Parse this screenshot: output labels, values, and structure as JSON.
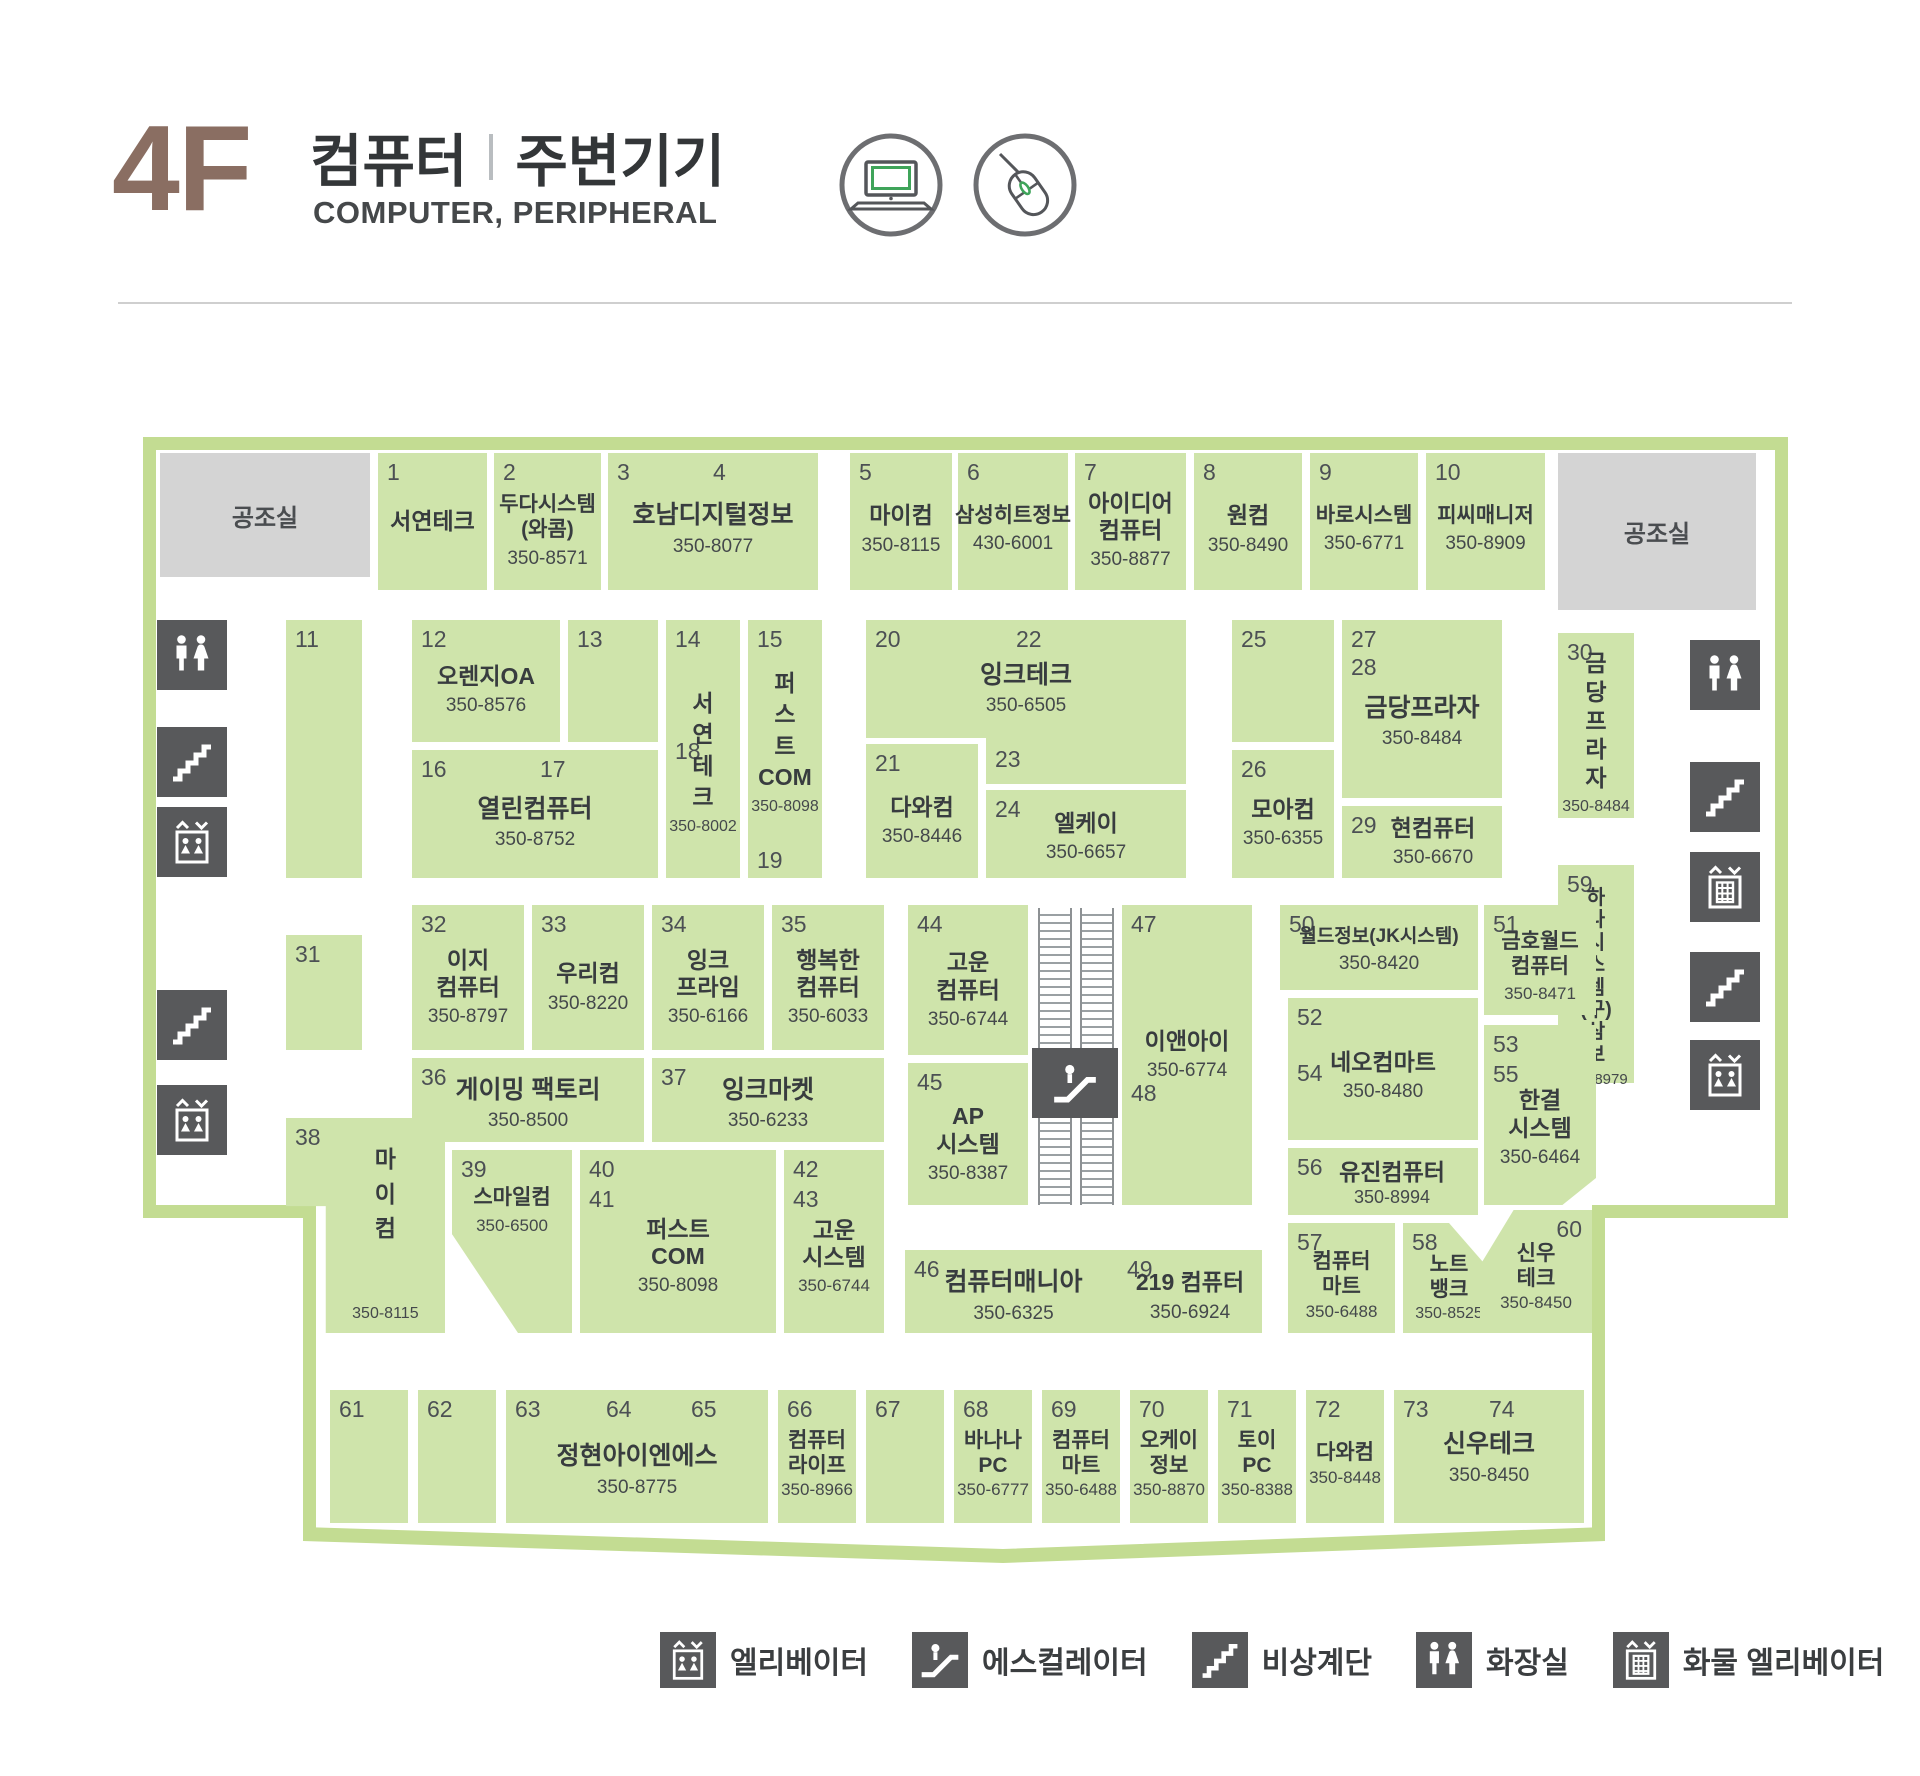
{
  "header": {
    "floor": "4F",
    "title_left": "컴퓨터",
    "title_right": "주변기기",
    "subtitle": "COMPUTER, PERIPHERAL"
  },
  "colors": {
    "block_green": "#cfe4ab",
    "outline_green": "#c3dc92",
    "machine_room_gray": "#d4d4d4",
    "icon_gray": "#58595b",
    "floor_label_brown": "#8a6e62",
    "accent_green": "#3fa45a"
  },
  "legend": {
    "items": [
      {
        "icon": "elevator-icon",
        "label": "엘리베이터"
      },
      {
        "icon": "escalator-icon",
        "label": "에스컬레이터"
      },
      {
        "icon": "stairs-icon",
        "label": "비상계단"
      },
      {
        "icon": "restroom-icon",
        "label": "화장실"
      },
      {
        "icon": "freight-elevator-icon",
        "label": "화물 엘리베이터"
      }
    ]
  },
  "map": {
    "machine_room_label": "공조실",
    "blocks": {
      "b1": {
        "nums": [
          "1"
        ],
        "name": "서연테크",
        "phone": ""
      },
      "b2": {
        "nums": [
          "2"
        ],
        "name": "두다시스템\n(와콤)",
        "phone": "350-8571"
      },
      "b3_4": {
        "nums": [
          "3",
          "4"
        ],
        "name": "호남디지털정보",
        "phone": "350-8077"
      },
      "b5": {
        "nums": [
          "5"
        ],
        "name": "마이컴",
        "phone": "350-8115"
      },
      "b6": {
        "nums": [
          "6"
        ],
        "name": "삼성히트정보",
        "phone": "430-6001"
      },
      "b7": {
        "nums": [
          "7"
        ],
        "name": "아이디어\n컴퓨터",
        "phone": "350-8877"
      },
      "b8": {
        "nums": [
          "8"
        ],
        "name": "원컴",
        "phone": "350-8490"
      },
      "b9": {
        "nums": [
          "9"
        ],
        "name": "바로시스템",
        "phone": "350-6771"
      },
      "b10": {
        "nums": [
          "10"
        ],
        "name": "피씨매니저",
        "phone": "350-8909"
      },
      "b11": {
        "nums": [
          "11"
        ],
        "name": "",
        "phone": ""
      },
      "b12": {
        "nums": [
          "12"
        ],
        "name": "오렌지OA",
        "phone": "350-8576"
      },
      "b13": {
        "nums": [
          "13"
        ],
        "name": "",
        "phone": ""
      },
      "b14_18": {
        "nums": [
          "14",
          "18"
        ],
        "name": "서\n연\n테\n크",
        "phone": "350-8002"
      },
      "b15_19": {
        "nums": [
          "15",
          "19"
        ],
        "name": "퍼\n스\n트\nCOM",
        "phone": "350-8098"
      },
      "b16_17": {
        "nums": [
          "16",
          "17"
        ],
        "name": "열린컴퓨터",
        "phone": "350-8752"
      },
      "b20_22": {
        "nums": [
          "20",
          "22",
          "23"
        ],
        "name": "잉크테크",
        "phone": "350-6505"
      },
      "b21": {
        "nums": [
          "21"
        ],
        "name": "다와컴",
        "phone": "350-8446"
      },
      "b24": {
        "nums": [
          "24"
        ],
        "name": "엘케이",
        "phone": "350-6657"
      },
      "b25": {
        "nums": [
          "25"
        ],
        "name": "",
        "phone": ""
      },
      "b26": {
        "nums": [
          "26"
        ],
        "name": "모아컴",
        "phone": "350-6355"
      },
      "b27_28": {
        "nums": [
          "27",
          "28"
        ],
        "name": "금당프라자",
        "phone": "350-8484"
      },
      "b29": {
        "nums": [
          "29"
        ],
        "name": "현컴퓨터",
        "phone": "350-6670"
      },
      "b30": {
        "nums": [
          "30"
        ],
        "name": "금\n당\n프\n라\n자",
        "phone": "350-8484"
      },
      "b31": {
        "nums": [
          "31"
        ],
        "name": "",
        "phone": ""
      },
      "b32": {
        "nums": [
          "32"
        ],
        "name": "이지\n컴퓨터",
        "phone": "350-8797"
      },
      "b33": {
        "nums": [
          "33"
        ],
        "name": "우리컴",
        "phone": "350-8220"
      },
      "b34": {
        "nums": [
          "34"
        ],
        "name": "잉크\n프라임",
        "phone": "350-6166"
      },
      "b35": {
        "nums": [
          "35"
        ],
        "name": "행복한\n컴퓨터",
        "phone": "350-6033"
      },
      "b36": {
        "nums": [
          "36"
        ],
        "name": "게이밍 팩토리",
        "phone": "350-8500"
      },
      "b37": {
        "nums": [
          "37"
        ],
        "name": "잉크마켓",
        "phone": "350-6233"
      },
      "b38": {
        "nums": [
          "38"
        ],
        "name": "마\n이\n컴",
        "phone": "350-8115"
      },
      "b39": {
        "nums": [
          "39"
        ],
        "name": "스마일컴",
        "phone": "350-6500"
      },
      "b40_41": {
        "nums": [
          "40",
          "41"
        ],
        "name": "퍼스트\nCOM",
        "phone": "350-8098"
      },
      "b42_43": {
        "nums": [
          "42",
          "43"
        ],
        "name": "고운\n시스템",
        "phone": "350-6744"
      },
      "b44": {
        "nums": [
          "44"
        ],
        "name": "고운\n컴퓨터",
        "phone": "350-6744"
      },
      "b45": {
        "nums": [
          "45"
        ],
        "name": "AP\n시스템",
        "phone": "350-8387"
      },
      "b46": {
        "nums": [
          "46"
        ],
        "name": "컴퓨터매니아",
        "phone": "350-6325"
      },
      "b47_48": {
        "nums": [
          "47",
          "48"
        ],
        "name": "이앤아이",
        "phone": "350-6774"
      },
      "b49": {
        "nums": [
          "49"
        ],
        "name": "219 컴퓨터",
        "phone": "350-6924"
      },
      "b50": {
        "nums": [
          "50"
        ],
        "name": "월드정보(JK시스템)",
        "phone": "350-8420"
      },
      "b51": {
        "nums": [
          "51"
        ],
        "name": "금호월드\n컴퓨터",
        "phone": "350-8471"
      },
      "b52_54": {
        "nums": [
          "52",
          "54"
        ],
        "name": "네오컴마트",
        "phone": "350-8480"
      },
      "b53_55": {
        "nums": [
          "53",
          "55"
        ],
        "name": "한결\n시스템",
        "phone": "350-6464"
      },
      "b56": {
        "nums": [
          "56"
        ],
        "name": "유진컴퓨터",
        "phone": "350-8994"
      },
      "b57": {
        "nums": [
          "57"
        ],
        "name": "컴퓨터\n마트",
        "phone": "350-6488"
      },
      "b58": {
        "nums": [
          "58"
        ],
        "name": "노트\n뱅크",
        "phone": "350-8525"
      },
      "b59": {
        "nums": [
          "59"
        ],
        "name": "하\n나\n시\n스\n템\n(구)\n삼\n보",
        "phone": "350-8979"
      },
      "b60": {
        "nums": [
          "60"
        ],
        "name": "신우\n테크",
        "phone": "350-8450"
      },
      "b61": {
        "nums": [
          "61"
        ],
        "name": "",
        "phone": ""
      },
      "b62": {
        "nums": [
          "62"
        ],
        "name": "",
        "phone": ""
      },
      "b63_64_65": {
        "nums": [
          "63",
          "64",
          "65"
        ],
        "name": "정현아이엔에스",
        "phone": "350-8775"
      },
      "b66": {
        "nums": [
          "66"
        ],
        "name": "컴퓨터\n라이프",
        "phone": "350-8966"
      },
      "b67": {
        "nums": [
          "67"
        ],
        "name": "",
        "phone": ""
      },
      "b68": {
        "nums": [
          "68"
        ],
        "name": "바나나\nPC",
        "phone": "350-6777"
      },
      "b69": {
        "nums": [
          "69"
        ],
        "name": "컴퓨터\n마트",
        "phone": "350-6488"
      },
      "b70": {
        "nums": [
          "70"
        ],
        "name": "오케이\n정보",
        "phone": "350-8870"
      },
      "b71": {
        "nums": [
          "71"
        ],
        "name": "토이\nPC",
        "phone": "350-8388"
      },
      "b72": {
        "nums": [
          "72"
        ],
        "name": "다와컴",
        "phone": "350-8448"
      },
      "b73_74": {
        "nums": [
          "73",
          "74"
        ],
        "name": "신우테크",
        "phone": "350-8450"
      }
    }
  }
}
